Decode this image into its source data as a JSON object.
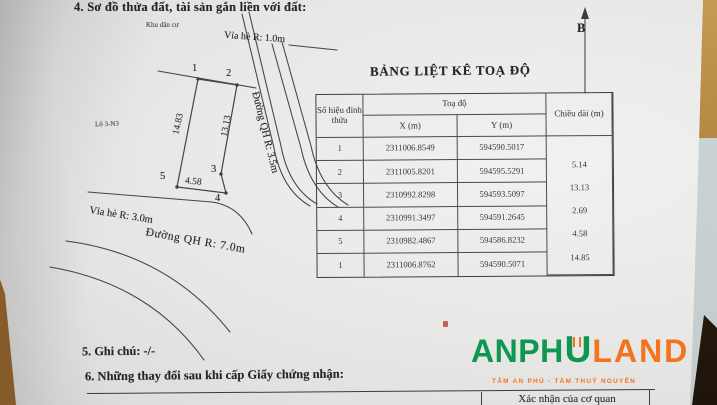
{
  "page": {
    "section4_title": "4. Sơ đồ thửa đất, tài sản gắn liền với đất:",
    "section5_title": "5. Ghi chú: -/-",
    "section6_title": "6. Những thay đổi sau khi cấp Giấy chứng nhận:",
    "signature_cell": "Xác nhận của cơ quan"
  },
  "diagram": {
    "area_label": "Khu dân cư",
    "lot_label": "Lô 3-N3",
    "sidewalk_top_label": "Vỉa hè R: 1.0m",
    "road_right_label": "Đường QH R: 3.5m",
    "sidewalk_bottom_label": "Vỉa hè R: 3.0m",
    "road_bottom_label": "Đường QH R: 7.0m",
    "north_label": "B",
    "vertices": [
      "1",
      "2",
      "3",
      "4",
      "5"
    ],
    "edge_labels": {
      "left": "14.83",
      "right": "13.13",
      "bottom": "4.58"
    }
  },
  "table": {
    "title": "BẢNG LIỆT KÊ TOẠ ĐỘ",
    "col_vertex": "Số hiệu đỉnh thửa",
    "col_coords": "Toạ độ",
    "col_x": "X (m)",
    "col_y": "Y (m)",
    "col_length": "Chiều dài (m)",
    "rows": [
      {
        "id": "1",
        "x": "2311006.8549",
        "y": "594590.5017"
      },
      {
        "id": "2",
        "x": "2311005.8201",
        "y": "594595.5291"
      },
      {
        "id": "3",
        "x": "2310992.8298",
        "y": "594593.5097"
      },
      {
        "id": "4",
        "x": "2310991.3497",
        "y": "594591.2645"
      },
      {
        "id": "5",
        "x": "2310982.4867",
        "y": "594586.8232"
      },
      {
        "id": "1",
        "x": "2311006.8762",
        "y": "594590.5071"
      }
    ],
    "lengths": [
      "5.14",
      "13.13",
      "2.69",
      "4.58",
      "14.85"
    ]
  },
  "logo": {
    "part1": "ANPH",
    "part2": "U",
    "part3": "LAND",
    "tagline": "TÂM AN PHÚ - TẦM THUỶ NGUYÊN",
    "green": "#0e9751",
    "orange": "#f4731f"
  }
}
